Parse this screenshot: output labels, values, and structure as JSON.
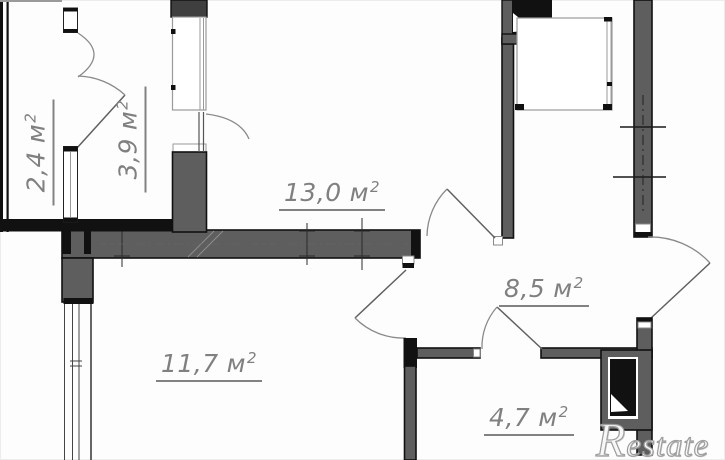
{
  "plan": {
    "rooms": [
      {
        "area": "2,4",
        "unit": "м",
        "exp": "2"
      },
      {
        "area": "3,9",
        "unit": "м",
        "exp": "2"
      },
      {
        "area": "13,0",
        "unit": "м",
        "exp": "2"
      },
      {
        "area": "8,5",
        "unit": "м",
        "exp": "2"
      },
      {
        "area": "11,7",
        "unit": "м",
        "exp": "2"
      },
      {
        "area": "4,7",
        "unit": "м",
        "exp": "2"
      }
    ],
    "watermark": "Restate",
    "colors": {
      "wall_fill": "#5e5e5e",
      "wall_outline": "#111111",
      "label_text": "#808080",
      "watermark_gray": "#9e9e9e",
      "background": "#fdfdfd"
    }
  }
}
